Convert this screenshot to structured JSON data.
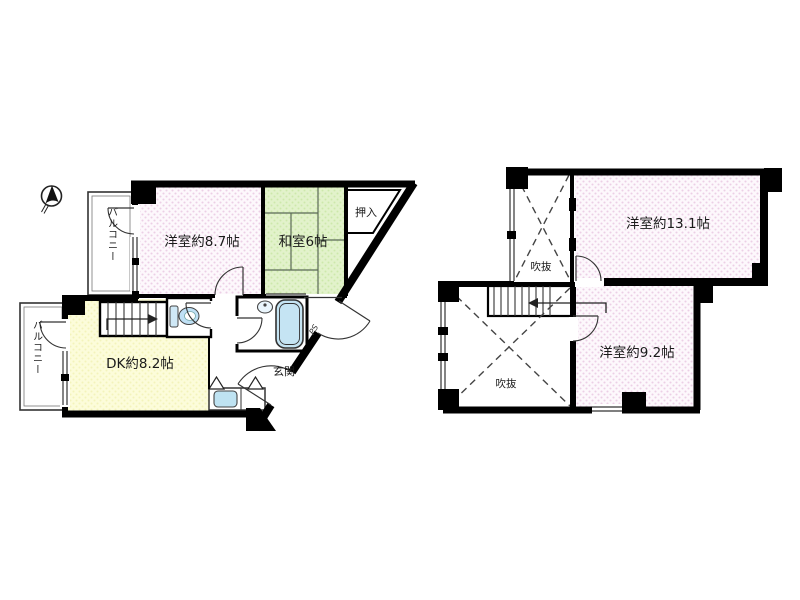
{
  "page": {
    "background": "#ffffff",
    "description": "two-floor Japanese apartment floor plan"
  },
  "colors": {
    "wall": "#000000",
    "pink_room_dot": "#eccfe6",
    "green_room": "#ddefc4",
    "yellow_room": "#fbfbd4",
    "fixture_blue": "#c5e4f3",
    "sink_blue": "#bfe3f2"
  },
  "compass": {
    "name": "north-arrow"
  },
  "floor1": {
    "rooms": {
      "western_room": {
        "label": "洋室約8.7帖"
      },
      "japanese_room": {
        "label": "和室6帖"
      },
      "closet": {
        "label": "押入"
      },
      "dining_kitchen": {
        "label": "DK約8.2帖"
      },
      "entrance": {
        "label": "玄関"
      },
      "pipe_space": {
        "label": "PS"
      },
      "balcony_upper": {
        "label": "バルコニー"
      },
      "balcony_lower": {
        "label": "バルコニー"
      }
    }
  },
  "floor2": {
    "rooms": {
      "western_room_13": {
        "label": "洋室約13.1帖"
      },
      "western_room_9": {
        "label": "洋室約9.2帖"
      },
      "void_upper": {
        "label": "吹抜"
      },
      "void_lower": {
        "label": "吹抜"
      }
    }
  }
}
